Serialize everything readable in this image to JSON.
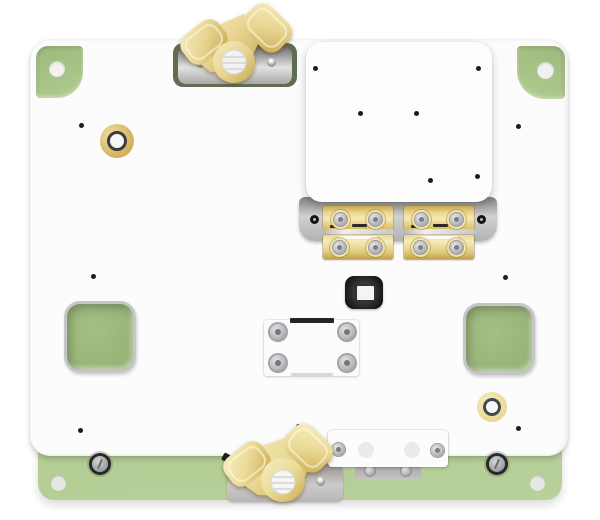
{
  "scene": {
    "description": "Top-down 3D render of a fixture: sage-green base plate under a white top plate; raised white sub-plate with two brass hinge clamps; two brass wing nuts on metal brackets (top and bottom edges); green square pass-through cutouts; brass bushings; assorted screws and alignment holes. No visible text.",
    "image_type": "3d-product-render"
  },
  "palette": {
    "base_green": "#a9c588",
    "base_green_dark": "#93af72",
    "base_green_light": "#b8d09a",
    "cutout_green": "#a3bf83",
    "plate_white": "#fcfcfd",
    "raised_white": "#fdfdfe",
    "bracket_grey": "#c2c1bf",
    "brass_light": "#f6ecc0",
    "brass": "#e6d28c",
    "brass_dark": "#c19a45",
    "gold_ring": "#d5b765",
    "hole_black": "#1c1c1e",
    "screw_silver": "#c6c6ca",
    "light_hole": "#f1f1ef"
  },
  "parts": {
    "green_base": "Green base plate",
    "white_plate": "White fixture top plate",
    "corner_tab": "Green corner post with locating hole",
    "raised_plate": "Raised white sub-plate",
    "carrier_plate": "Metal hinge carrier plate",
    "hinge": "Brass hinge clamp",
    "wing_nut": "Brass wing nut",
    "bracket": "Metal mounting bracket",
    "camera_socket": "Black socket with white insert",
    "center_block": "Center mounting block with four screws",
    "cutout": "Green square pass-through cutout",
    "gold_ring": "Brass bushing with bore",
    "screw": "Machine screw",
    "hole": "Alignment hole"
  }
}
